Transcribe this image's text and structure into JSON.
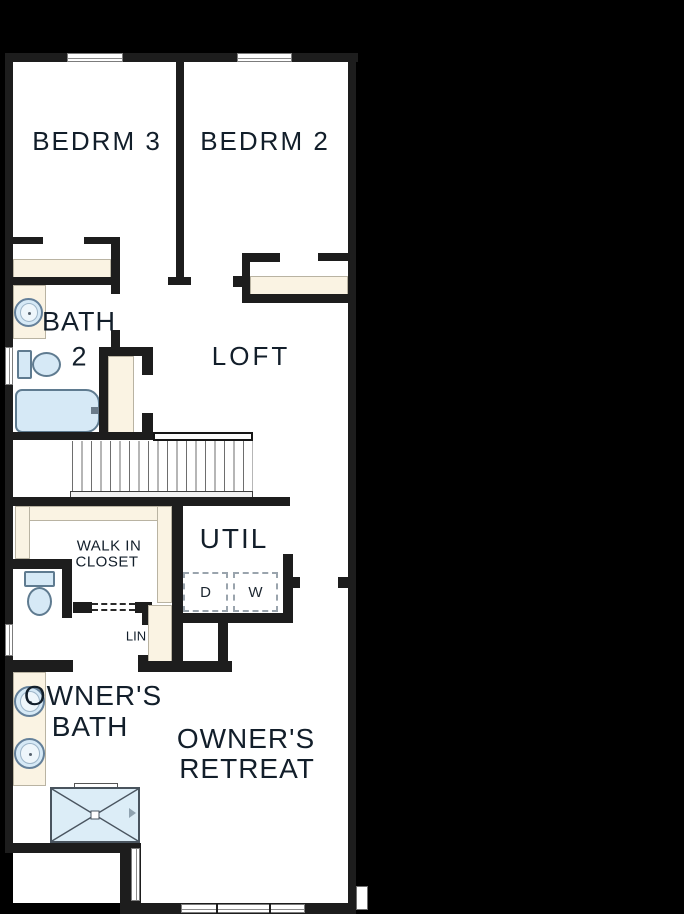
{
  "plan": {
    "type": "floor-plan",
    "floor": "second-floor",
    "rooms": {
      "bedrm3": "BEDRM 3",
      "bedrm2": "BEDRM 2",
      "bath2_l1": "BATH",
      "bath2_l2": "2",
      "loft": "LOFT",
      "walkin_l1": "WALK IN",
      "walkin_l2": "CLOSET",
      "util": "UTIL",
      "lin": "LIN",
      "owners_bath_l1": "OWNER'S",
      "owners_bath_l2": "BATH",
      "owners_retreat_l1": "OWNER'S",
      "owners_retreat_l2": "RETREAT"
    },
    "appliances": {
      "dryer": "D",
      "washer": "W"
    },
    "fixtures": [
      "bathtub",
      "toilet",
      "sink",
      "shower",
      "stairs",
      "washer",
      "dryer",
      "vanity",
      "closet-shelves",
      "windows"
    ],
    "colors": {
      "background": "#000000",
      "floor": "#ffffff",
      "wall": "#1d1d1d",
      "shelf_beige": "#faf3e3",
      "fixture_blue": "#d6e9f6",
      "label_text": "#121e2a"
    }
  }
}
